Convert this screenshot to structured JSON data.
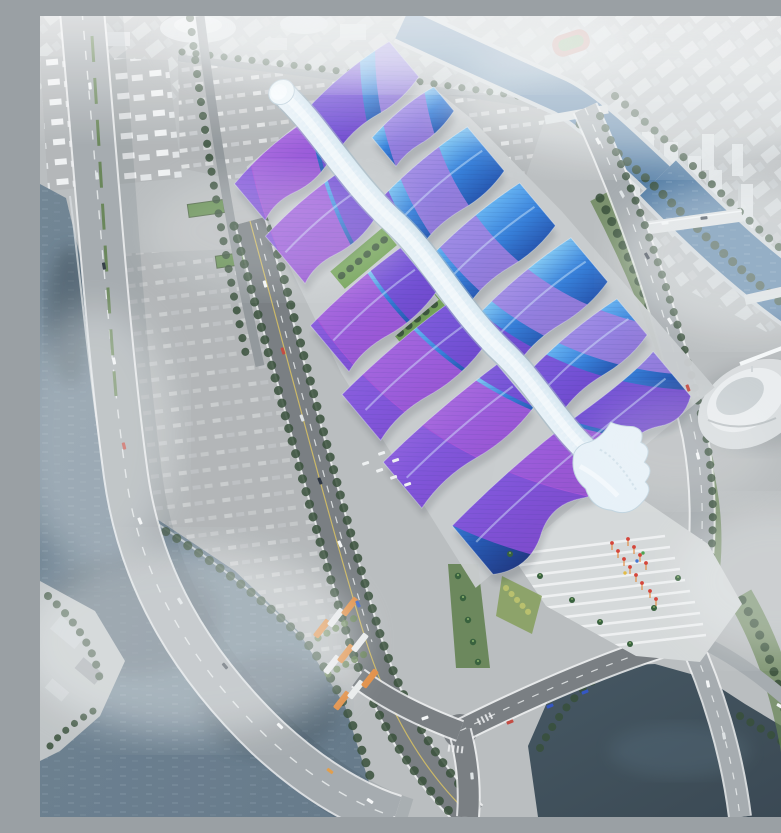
{
  "scene": {
    "title": "Aerial rendering of a riverside exhibition and convention center with wavy blue and purple roofs",
    "description": "Bird's-eye architectural visualization: a vast exhibition complex runs diagonally across the frame. A pearlescent serpentine concourse ribbon follows the spine of staggered halls whose wavy metal roofs shade from bright blue into sweeping violet and magenta arcs, with green courtyards between halls. The complex is flanked by gray parking fields and a truck depot to the northwest, an elevated expressway that bridges a broad gray-blue river in the southwest corner, a tree-lined arterial with a bus depot to the west, a canal crossed by bridges with hazy white towers and city blocks to the northeast, a curved white cultural pavilion to the east, and a south entry plaza with terraced white steps, palm trees and red festival flags beside a dark pond in the southeast corner. Soft white haze drifts across the scene."
  },
  "landmarks": [
    {
      "id": "exhibition-complex",
      "label": "Exhibition hall complex with wavy blue-purple roofs"
    },
    {
      "id": "central-ribbon",
      "label": "White serpentine central concourse"
    },
    {
      "id": "hall-roofs",
      "label": "Staggered exhibition hall roofs"
    },
    {
      "id": "purple-arc-overlay",
      "label": "Violet and magenta arc pattern across roofs"
    },
    {
      "id": "courtyards",
      "label": "Green landscaped courtyards between halls"
    },
    {
      "id": "parking-lot-north",
      "label": "Northern surface parking field"
    },
    {
      "id": "truck-depot-northwest",
      "label": "Truck and trailer depot"
    },
    {
      "id": "parking-lot-west",
      "label": "Western parking field with green-roof sheds"
    },
    {
      "id": "expressway",
      "label": "Elevated expressway and river bridge"
    },
    {
      "id": "arterial-road-west",
      "label": "Tree-lined arterial road"
    },
    {
      "id": "bus-depot-south",
      "label": "Bus staging lot"
    },
    {
      "id": "river-southwest",
      "label": "Broad river in southwest corner"
    },
    {
      "id": "canal-northeast",
      "label": "Canal with bridges"
    },
    {
      "id": "city-district-east",
      "label": "Hazy white towers and city blocks"
    },
    {
      "id": "cultural-pavilion-east",
      "label": "Curved white pavilion"
    },
    {
      "id": "plaza-south",
      "label": "South entry plaza with terraced steps"
    },
    {
      "id": "festival-flags",
      "label": "Red and orange festival flags"
    },
    {
      "id": "palm-trees",
      "label": "Palm trees along the plaza"
    },
    {
      "id": "pond-southeast",
      "label": "Dark pond in southeast corner"
    },
    {
      "id": "haze-overlay",
      "label": "Soft white atmospheric haze"
    }
  ],
  "palette": {
    "ground": "#b7bbbd",
    "ground_light": "#c6cacc",
    "plaza": "#d3d7d8",
    "asphalt_lot": "#aeb2b4",
    "road_dark": "#73797d",
    "road_light": "#a2a8ac",
    "lane_white": "#eef0f1",
    "facade_gray": "#c7cbcd",
    "city_block": "#d3d8da",
    "roof_blue_light": "#5fb0f2",
    "roof_blue": "#2e7ad8",
    "roof_blue_deep": "#1c50ae",
    "roof_navy": "#16307e",
    "roof_cyan_light": "#7cc6f4",
    "purple": "#7b3ed2",
    "purple_deep": "#8a46d8",
    "magenta": "#a94fd8",
    "violet_light": "#a87ae0",
    "ribbon_light": "#f3f9fc",
    "ribbon": "#dcebf4",
    "ribbon_shade": "#9db6c4",
    "water_canal": "#49759f",
    "water_river": "#5e7384",
    "water_dark": "#303f4a",
    "green_dark": "#3c5a38",
    "green_mid": "#5c7c49",
    "green_lawn": "#6fa052",
    "tree_dark": "#2e4630",
    "red_accent": "#d23c30",
    "orange_accent": "#e08a3e",
    "haze": "#f2f5f6"
  }
}
